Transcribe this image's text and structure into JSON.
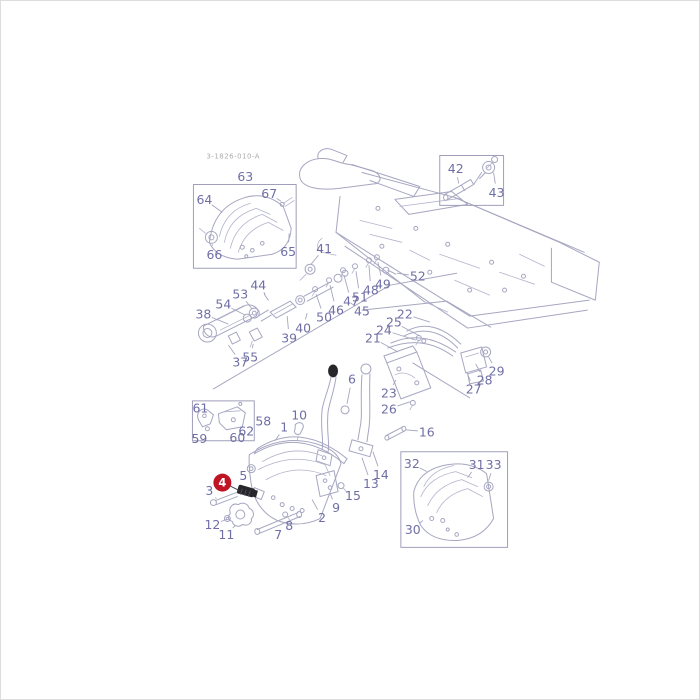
{
  "page": {
    "background": "#ffffff",
    "frame_color": "#dddddd"
  },
  "diagram": {
    "drawing_number": "3-1826-010-A",
    "colors": {
      "label": "#6f6fa6",
      "line": "#a6a6c1",
      "dark_part": "#26262b",
      "highlight": "#c01425",
      "highlight_text": "#ffffff"
    },
    "highlight": {
      "text": "4",
      "x": 222,
      "y": 483,
      "r": 9,
      "leader_x": 239,
      "leader_y": 491
    },
    "labels": [
      {
        "n": "63",
        "x": 245,
        "y": 176,
        "lx": 247,
        "ly": 185
      },
      {
        "n": "64",
        "x": 204,
        "y": 199,
        "lx": 222,
        "ly": 212
      },
      {
        "n": "67",
        "x": 269,
        "y": 193,
        "lx": 281,
        "ly": 201
      },
      {
        "n": "66",
        "x": 214,
        "y": 254,
        "lx": 212,
        "ly": 244
      },
      {
        "n": "65",
        "x": 288,
        "y": 251,
        "lx": 289,
        "ly": 233
      },
      {
        "n": "42",
        "x": 456,
        "y": 168,
        "lx": 459,
        "ly": 183
      },
      {
        "n": "43",
        "x": 497,
        "y": 192,
        "lx": 494,
        "ly": 172
      },
      {
        "n": "41",
        "x": 324,
        "y": 248,
        "lx": 311,
        "ly": 264
      },
      {
        "n": "52",
        "x": 418,
        "y": 276,
        "lx": 397,
        "ly": 273
      },
      {
        "n": "49",
        "x": 383,
        "y": 284,
        "lx": 378,
        "ly": 262
      },
      {
        "n": "48",
        "x": 371,
        "y": 290,
        "lx": 369,
        "ly": 265
      },
      {
        "n": "51",
        "x": 360,
        "y": 297,
        "lx": 356,
        "ly": 271
      },
      {
        "n": "47",
        "x": 351,
        "y": 301,
        "lx": 344,
        "ly": 275
      },
      {
        "n": "46",
        "x": 336,
        "y": 310,
        "lx": 330,
        "ly": 285
      },
      {
        "n": "50",
        "x": 324,
        "y": 317,
        "lx": 316,
        "ly": 294
      },
      {
        "n": "45",
        "x": 362,
        "y": 311,
        "lx": 351,
        "ly": 303
      },
      {
        "n": "44",
        "x": 258,
        "y": 285,
        "lx": 265,
        "ly": 294
      },
      {
        "n": "53",
        "x": 240,
        "y": 294,
        "lx": 252,
        "ly": 309
      },
      {
        "n": "54",
        "x": 223,
        "y": 304,
        "lx": 245,
        "ly": 315
      },
      {
        "n": "38",
        "x": 203,
        "y": 314,
        "lx": 228,
        "ly": 324
      },
      {
        "n": "40",
        "x": 303,
        "y": 328,
        "lx": 307,
        "ly": 313
      },
      {
        "n": "39",
        "x": 289,
        "y": 338,
        "lx": 287,
        "ly": 316
      },
      {
        "n": "37",
        "x": 240,
        "y": 362,
        "lx": 228,
        "ly": 345
      },
      {
        "n": "55",
        "x": 250,
        "y": 357,
        "lx": 253,
        "ly": 344
      },
      {
        "n": "22",
        "x": 405,
        "y": 314,
        "lx": 430,
        "ly": 322
      },
      {
        "n": "25",
        "x": 394,
        "y": 322,
        "lx": 420,
        "ly": 336
      },
      {
        "n": "24",
        "x": 384,
        "y": 330,
        "lx": 416,
        "ly": 340
      },
      {
        "n": "21",
        "x": 373,
        "y": 338,
        "lx": 398,
        "ly": 352
      },
      {
        "n": "23",
        "x": 389,
        "y": 393,
        "lx": 396,
        "ly": 380
      },
      {
        "n": "26",
        "x": 389,
        "y": 409,
        "lx": 410,
        "ly": 402
      },
      {
        "n": "27",
        "x": 474,
        "y": 389,
        "lx": 467,
        "ly": 372
      },
      {
        "n": "28",
        "x": 485,
        "y": 380,
        "lx": 476,
        "ly": 364
      },
      {
        "n": "29",
        "x": 497,
        "y": 371,
        "lx": 489,
        "ly": 357
      },
      {
        "n": "16",
        "x": 427,
        "y": 432,
        "lx": 406,
        "ly": 430
      },
      {
        "n": "6",
        "x": 352,
        "y": 379,
        "lx": 347,
        "ly": 404
      },
      {
        "n": "14",
        "x": 381,
        "y": 475,
        "lx": 373,
        "ly": 452
      },
      {
        "n": "13",
        "x": 371,
        "y": 484,
        "lx": 362,
        "ly": 458
      },
      {
        "n": "15",
        "x": 353,
        "y": 496,
        "lx": 345,
        "ly": 490
      },
      {
        "n": "9",
        "x": 336,
        "y": 508,
        "lx": 330,
        "ly": 494
      },
      {
        "n": "2",
        "x": 322,
        "y": 518,
        "lx": 312,
        "ly": 500
      },
      {
        "n": "8",
        "x": 289,
        "y": 526,
        "lx": 286,
        "ly": 519
      },
      {
        "n": "7",
        "x": 278,
        "y": 535,
        "lx": 270,
        "ly": 530
      },
      {
        "n": "11",
        "x": 226,
        "y": 535,
        "lx": 235,
        "ly": 526
      },
      {
        "n": "12",
        "x": 212,
        "y": 525,
        "lx": 226,
        "ly": 520
      },
      {
        "n": "5",
        "x": 243,
        "y": 476,
        "lx": 249,
        "ly": 471
      },
      {
        "n": "3",
        "x": 209,
        "y": 491,
        "lx": 216,
        "ly": 499
      },
      {
        "n": "1",
        "x": 284,
        "y": 427,
        "lx": 275,
        "ly": 441
      },
      {
        "n": "10",
        "x": 299,
        "y": 415,
        "lx": 299,
        "ly": 425
      },
      {
        "n": "61",
        "x": 200,
        "y": 408,
        "lx": 205,
        "ly": 413
      },
      {
        "n": "59",
        "x": 199,
        "y": 439,
        "lx": 204,
        "ly": 431
      },
      {
        "n": "60",
        "x": 237,
        "y": 438,
        "lx": 235,
        "ly": 430
      },
      {
        "n": "62",
        "x": 246,
        "y": 431,
        "lx": 241,
        "ly": 424
      },
      {
        "n": "58",
        "x": 263,
        "y": 421,
        "lx": 255,
        "ly": 421
      },
      {
        "n": "32",
        "x": 412,
        "y": 464,
        "lx": 427,
        "ly": 472
      },
      {
        "n": "31",
        "x": 477,
        "y": 465,
        "lx": 468,
        "ly": 478
      },
      {
        "n": "33",
        "x": 494,
        "y": 465,
        "lx": 489,
        "ly": 481
      },
      {
        "n": "30",
        "x": 413,
        "y": 530,
        "lx": 423,
        "ly": 521
      }
    ]
  }
}
